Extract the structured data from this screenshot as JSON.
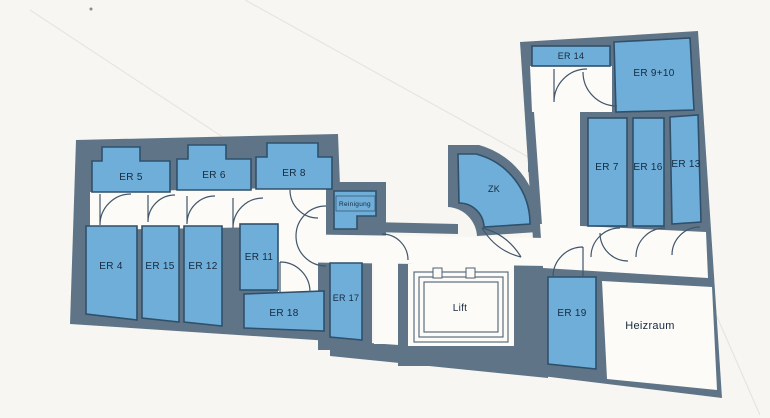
{
  "rooms": {
    "er5": "ER 5",
    "er6": "ER 6",
    "er8": "ER 8",
    "er4": "ER 4",
    "er15": "ER 15",
    "er12": "ER 12",
    "er11": "ER 11",
    "er18": "ER 18",
    "er17": "ER 17",
    "reinigung": "Reinigung",
    "zk": "ZK",
    "lift": "Lift",
    "er14": "ER 14",
    "er910": "ER 9+10",
    "er7": "ER 7",
    "er16": "ER 16",
    "er13": "ER 13",
    "er19": "ER 19",
    "heizraum": "Heizraum"
  },
  "colors": {
    "paper": "#f7f6f2",
    "wall_gray": "#5f7487",
    "room_fill_blue": "#6faed9",
    "room_outline": "#2f506b",
    "door_stroke": "#40566b",
    "floor_white": "#fcfbf8",
    "label_text": "#16293c"
  }
}
